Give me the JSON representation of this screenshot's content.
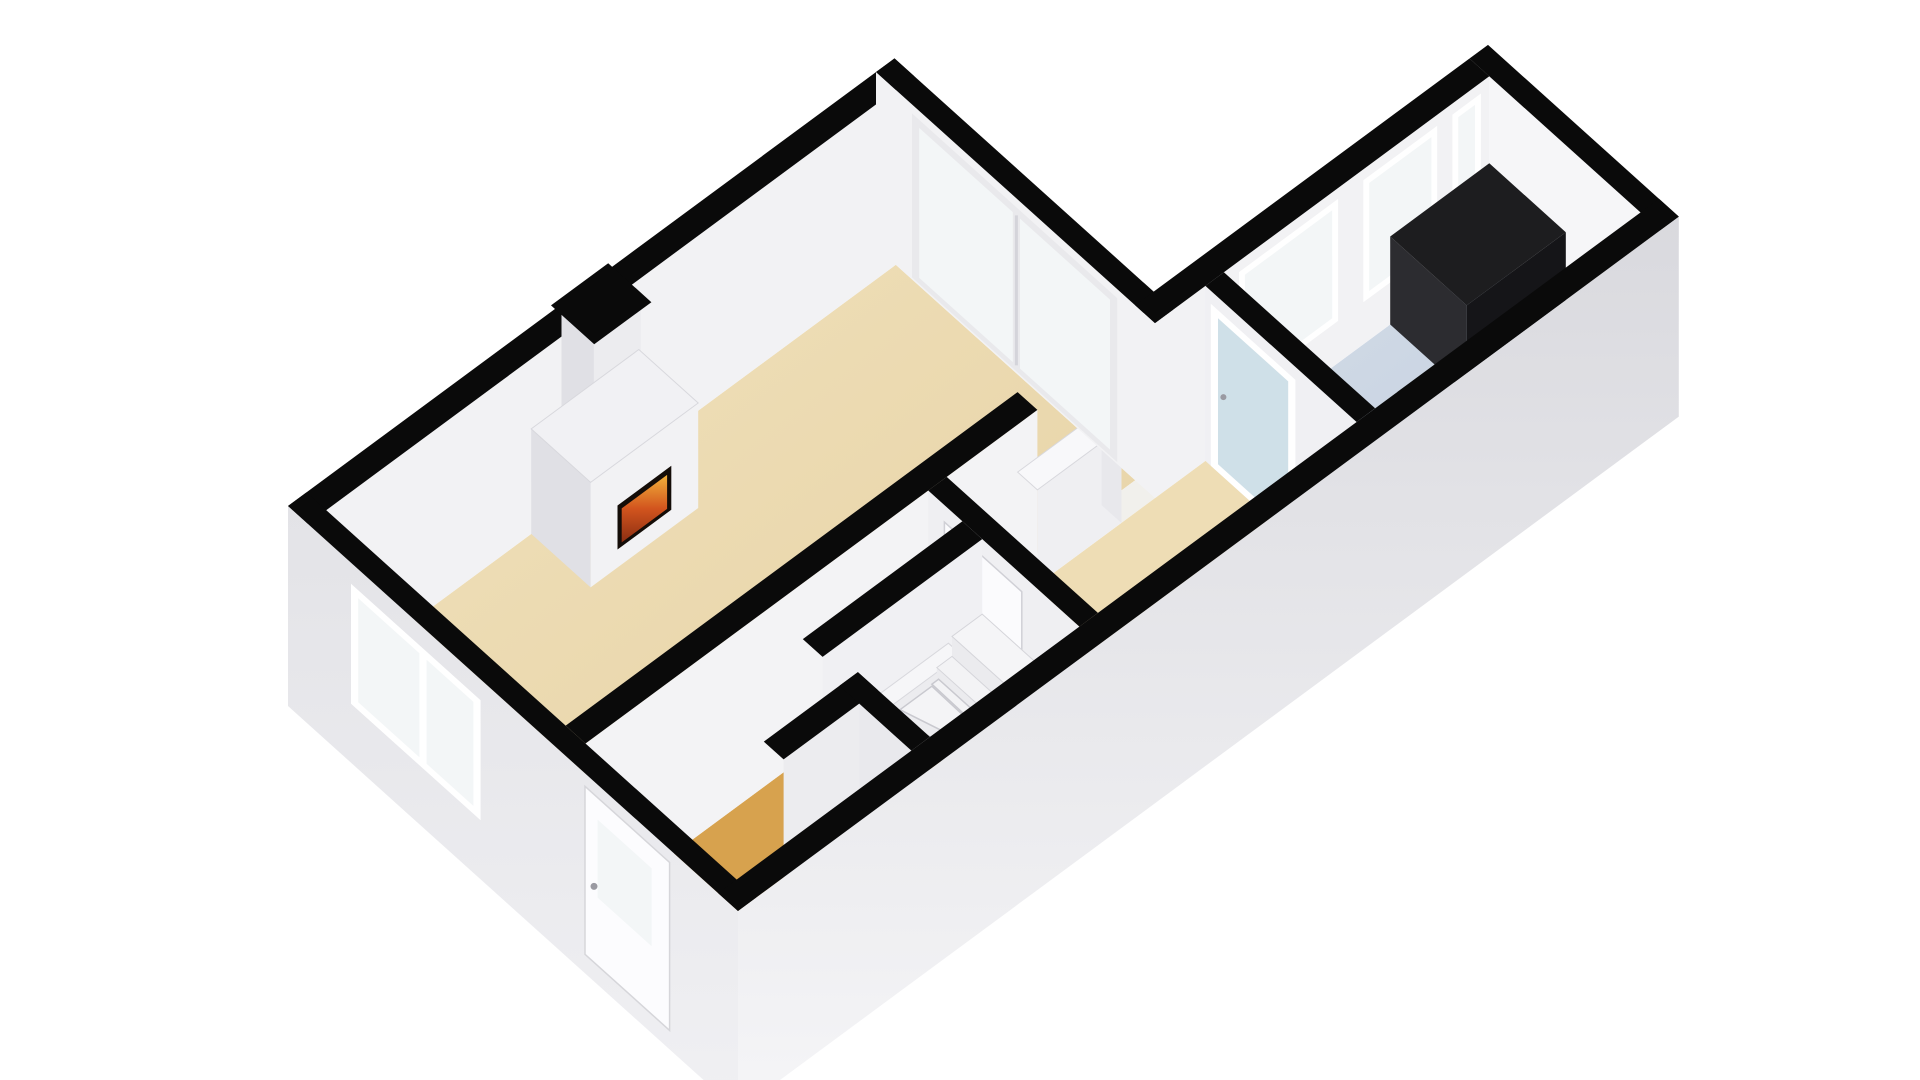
{
  "scene": {
    "type": "3d-floorplan-render",
    "description": "axonometric one-floor apartment render",
    "rooms": [
      {
        "name": "living-room",
        "floor": "beige"
      },
      {
        "name": "hallway",
        "floor": "orange"
      },
      {
        "name": "middle-room",
        "floor": "beige"
      },
      {
        "name": "kitchen",
        "floor": "blue"
      },
      {
        "name": "stairwell",
        "floor": "white"
      },
      {
        "name": "boiler-closet",
        "floor": "grey"
      }
    ],
    "fixtures": [
      "fireplace",
      "chimney",
      "winder-staircase",
      "kitchen-counter",
      "boiler-unit",
      "shower-pad",
      "floor-strip"
    ],
    "openings": [
      "front-door",
      "living-window",
      "sliding-glass-doors",
      "kitchen-windows",
      "kitchen-glass-door",
      "hall-door",
      "passage-opening"
    ]
  },
  "palette": {
    "background": "#ffffff",
    "wall_top": "#0a0a0a",
    "wall_light": "#f2f2f4",
    "wall_bright": "#f6f6f8",
    "wall_mid": "#ececef",
    "wall_shade": "#e0e0e5",
    "ext_top": "#d9d9de",
    "ext_bottom": "#f5f5f7",
    "ext_sw_top": "#e3e3e7",
    "ext_sw_bottom": "#f0f0f3",
    "floor_beige_light": "#f1e2bd",
    "floor_beige": "#eeddb5",
    "floor_beige_dark": "#e5d0a2",
    "floor_hall": "#d7a24e",
    "floor_kitchen_light": "#d3dce8",
    "floor_kitchen_dark": "#c2cedd",
    "sill_white": "#f1f0ec",
    "closet_floor": "#d8d8dc",
    "glass": "#f3f6f7",
    "glass_teal": "#cfe0e8",
    "frame_white": "#ffffff",
    "frame_grey": "#e9e9ec",
    "mullion": "#d4d4da",
    "counter_top": "#1d1d1f",
    "counter_front": "#151518",
    "counter_side": "#2c2c30",
    "fire_surround": "#140d08",
    "fire_top": "#f2b13a",
    "fire_mid": "#d2541e",
    "fire_deep": "#8c2f12",
    "boiler_dark": "#2e2e32",
    "boiler_darker": "#1f1f22",
    "boiler_red": "#c0392b",
    "boiler_red_dark": "#962d22",
    "stair": "#f4f4f6",
    "stair_shade": "#ebebee",
    "seam": "#c9c9cf",
    "edge": "#d8d8dd",
    "handle": "#9a9aa2"
  }
}
